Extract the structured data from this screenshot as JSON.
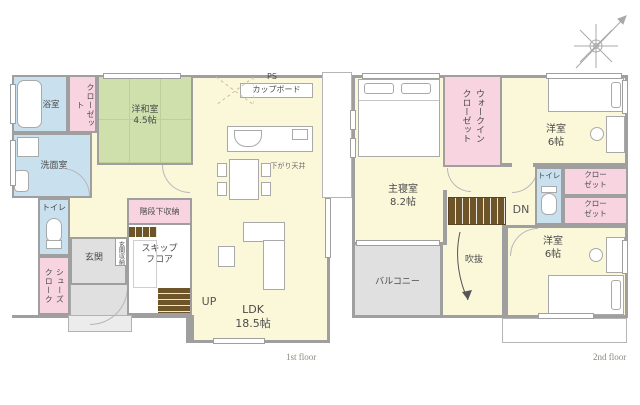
{
  "palette": {
    "room_yellow": "#fbf8da",
    "wet_area_blue": "#c9e0ef",
    "closet_pink": "#f7d4e0",
    "tatami_green": "#cfe0ad",
    "entrance_gray": "#e0e0e0",
    "wall_gray": "#9f9f9f",
    "stair_brown": "#6e5429"
  },
  "floor1": {
    "floor_label": "1st floor",
    "bath": "浴室",
    "closet": "クローゼット",
    "washroom": "洗面室",
    "japanese_room": "洋和室",
    "japanese_room_size": "4.5帖",
    "toilet": "トイレ",
    "shoes_closet": "シューズクローク",
    "entrance": "玄関",
    "entrance_storage": "玄関収納",
    "under_stair_storage": "階段下収納",
    "skip_floor_line1": "スキップ",
    "skip_floor_line2": "フロア",
    "ldk": "LDK",
    "ldk_size": "18.5帖",
    "up": "UP",
    "ps": "PS",
    "cupboard": "カップボード",
    "lowered_ceiling": "下がり天井"
  },
  "floor2": {
    "floor_label": "2nd floor",
    "master_bedroom": "主寝室",
    "master_bedroom_size": "8.2帖",
    "walk_in_closet": "ウォークインクローゼット",
    "bedroom_north": "洋室",
    "bedroom_north_size": "6帖",
    "toilet": "トイレ",
    "closet_a": "クローゼット",
    "closet_b": "クローゼット",
    "dn": "DN",
    "balcony": "バルコニー",
    "void": "吹抜",
    "bedroom_south": "洋室",
    "bedroom_south_size": "6帖"
  }
}
